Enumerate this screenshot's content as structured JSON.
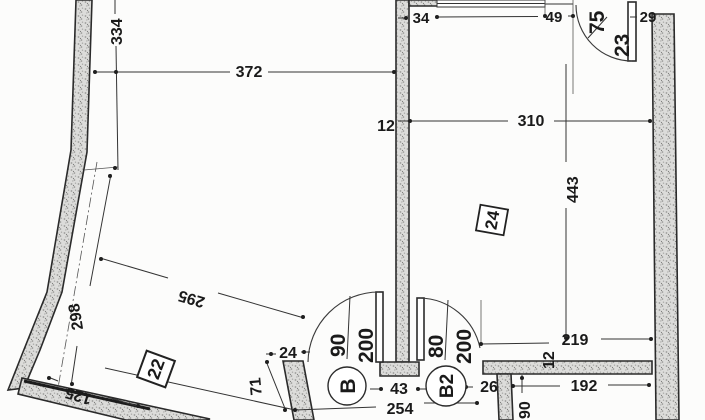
{
  "drawing": {
    "title": "apartment floor plan scan",
    "rooms": {
      "room22": {
        "number": "22"
      },
      "room24": {
        "number": "24"
      }
    },
    "doors": {
      "b": {
        "tag": "B",
        "width": "90",
        "height": "200"
      },
      "b2": {
        "tag": "B2",
        "width": "80",
        "height": "200"
      },
      "top": {
        "width": "75",
        "height": "23"
      }
    },
    "dims": {
      "d334": "334",
      "d372": "372",
      "d34": "34",
      "d49": "49",
      "d29": "29",
      "d310": "310",
      "d12_top": "12",
      "d443": "443",
      "d295": "295",
      "d298": "298",
      "d125": "125",
      "d24": "24",
      "d71": "71",
      "d254": "254",
      "d43": "43",
      "d26": "26",
      "d219": "219",
      "d12_bottom": "12",
      "d192": "192",
      "d90": "90"
    },
    "colors": {
      "ink": "#1a1a1a",
      "wall_speckle": "#9a9a98",
      "paper": "#fcfcfb"
    }
  }
}
